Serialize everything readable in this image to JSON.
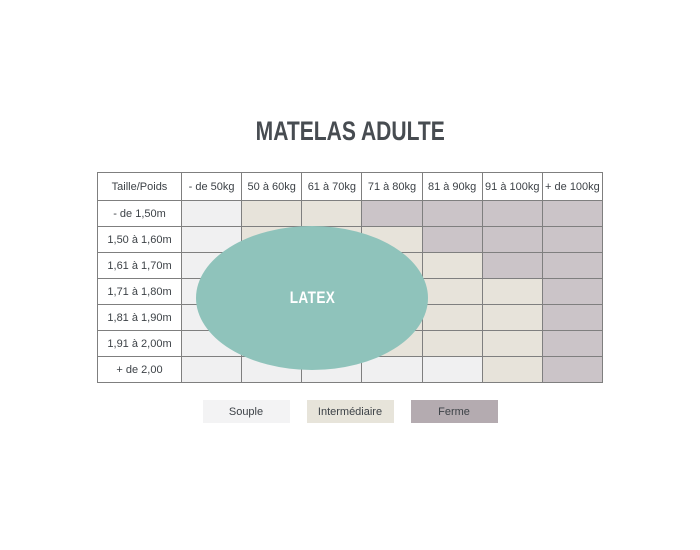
{
  "title": "MATELAS ADULTE",
  "chart_data": {
    "type": "heatmap",
    "title": "MATELAS ADULTE",
    "corner_label": "Taille/Poids",
    "columns": [
      "- de 50kg",
      "50 à 60kg",
      "61 à 70kg",
      "71 à 80kg",
      "81 à 90kg",
      "91 à 100kg",
      "+ de 100kg"
    ],
    "rows": [
      "- de 1,50m",
      "1,50 à 1,60m",
      "1,61 à 1,70m",
      "1,71 à 1,80m",
      "1,81 à 1,90m",
      "1,91 à 2,00m",
      "+ de 2,00"
    ],
    "values": [
      [
        "souple",
        "intermediaire",
        "intermediaire",
        "ferme",
        "ferme",
        "ferme",
        "ferme"
      ],
      [
        "souple",
        "intermediaire",
        "intermediaire",
        "intermediaire",
        "ferme",
        "ferme",
        "ferme"
      ],
      [
        "souple",
        "souple",
        "intermediaire",
        "intermediaire",
        "intermediaire",
        "ferme",
        "ferme"
      ],
      [
        "souple",
        "souple",
        "intermediaire",
        "intermediaire",
        "intermediaire",
        "intermediaire",
        "ferme"
      ],
      [
        "souple",
        "souple",
        "souple",
        "intermediaire",
        "intermediaire",
        "intermediaire",
        "ferme"
      ],
      [
        "souple",
        "souple",
        "souple",
        "intermediaire",
        "intermediaire",
        "intermediaire",
        "ferme"
      ],
      [
        "souple",
        "souple",
        "souple",
        "souple",
        "souple",
        "intermediaire",
        "ferme"
      ]
    ],
    "cell_colors": {
      "souple": "#f0f0f1",
      "intermediaire": "#e7e3da",
      "ferme": "#cbc4c8"
    },
    "overlay": {
      "label": "LATEX",
      "color": "#8fc3bb"
    },
    "legend": [
      {
        "key": "souple",
        "label": "Souple",
        "swatch_color": "#f3f3f4"
      },
      {
        "key": "intermediaire",
        "label": "Intermédiaire",
        "swatch_color": "#e7e4da"
      },
      {
        "key": "ferme",
        "label": "Ferme",
        "swatch_color": "#b4abb0"
      }
    ]
  }
}
